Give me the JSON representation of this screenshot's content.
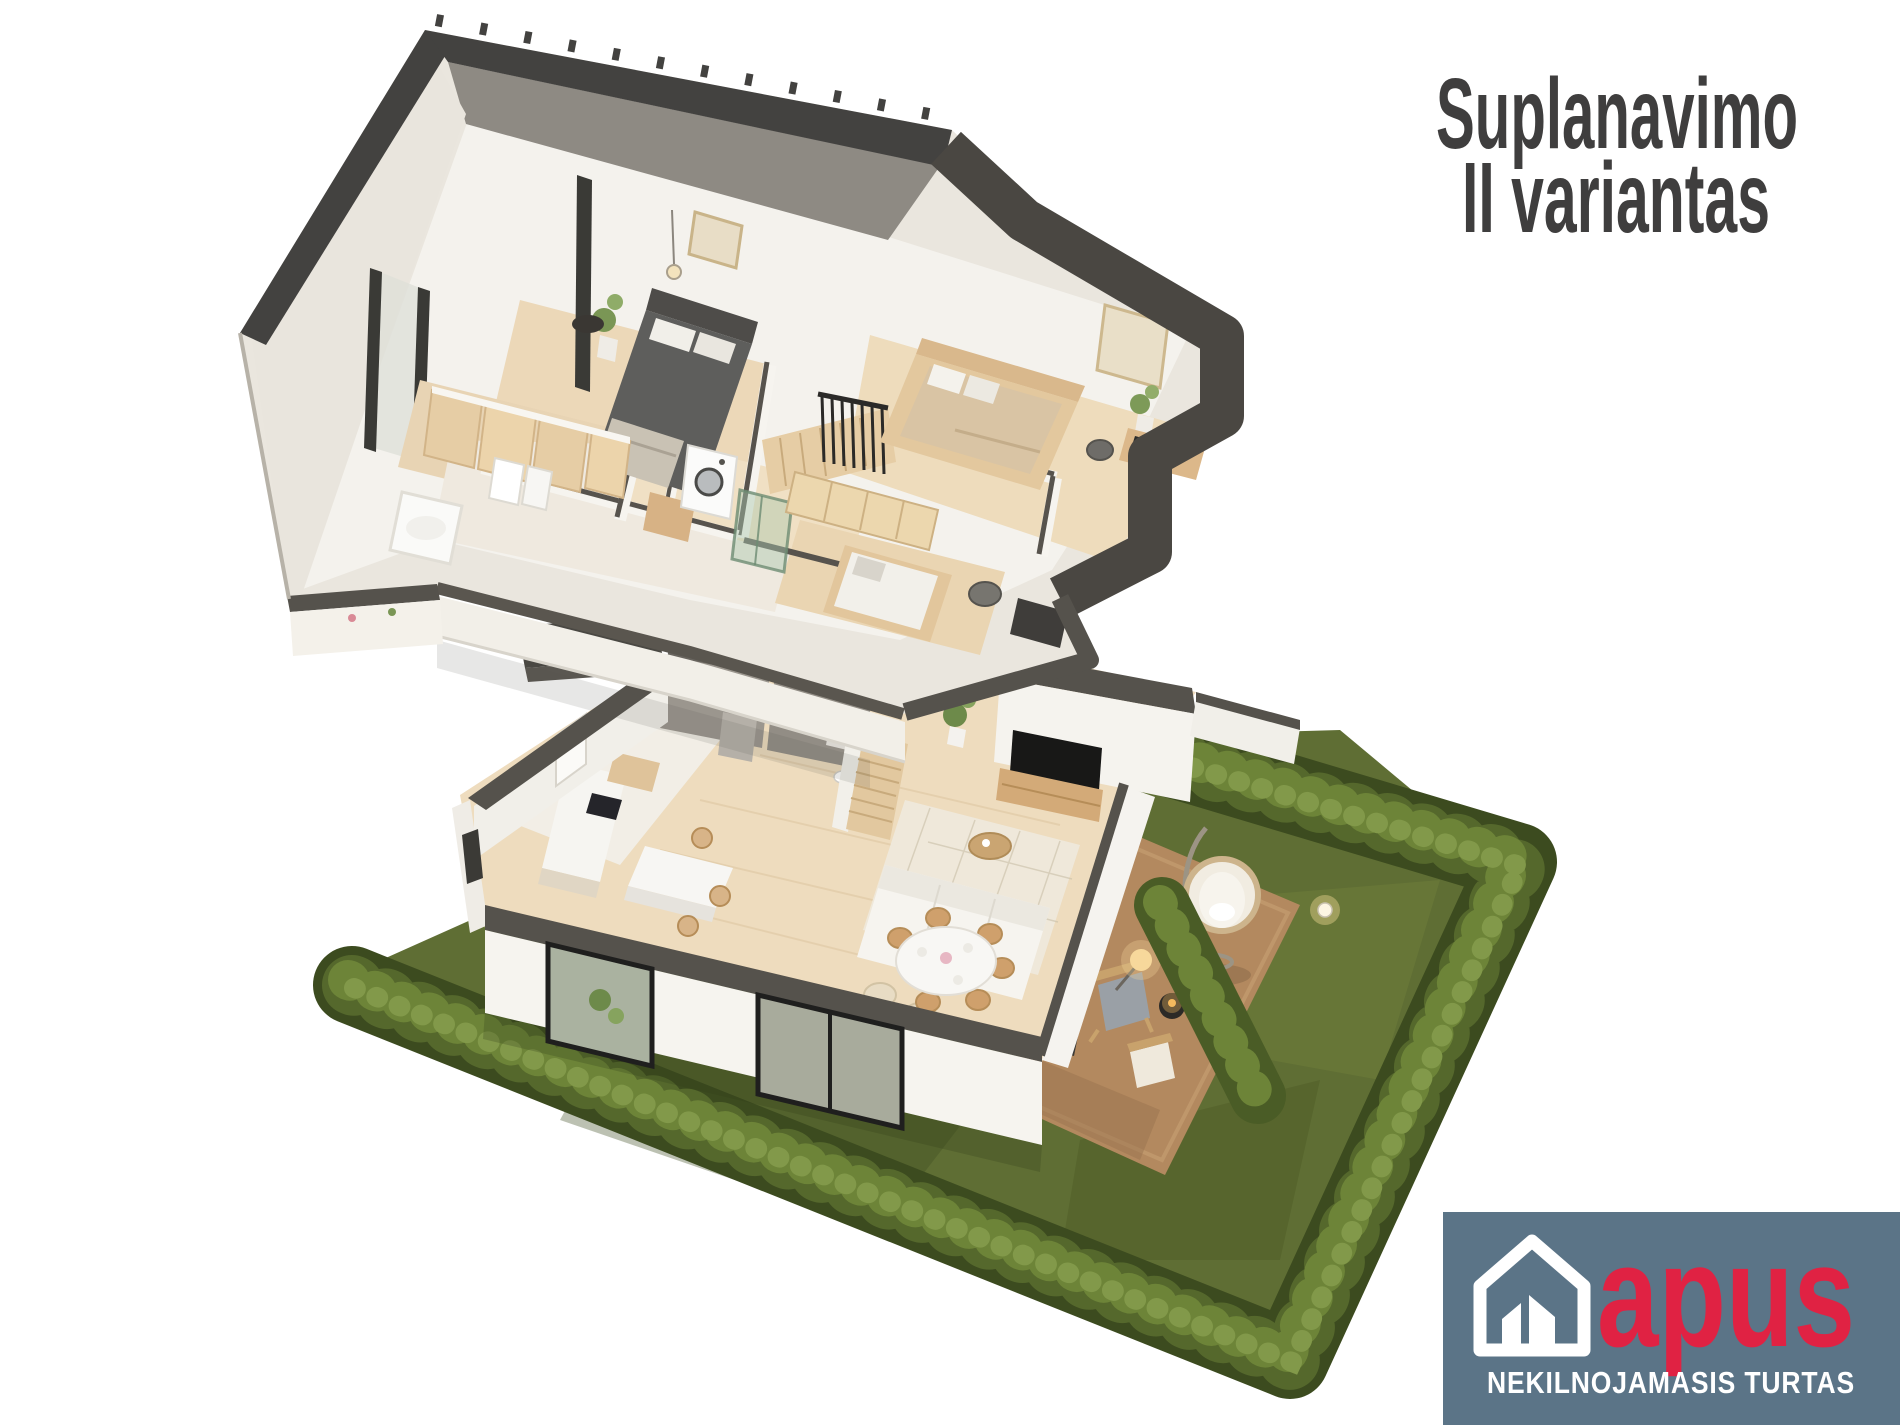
{
  "title": {
    "line1": "Suplanavimo",
    "line2": "II variantas"
  },
  "logo": {
    "brand": "apus",
    "tagline": "NEKILNOJAMASIS TURTAS",
    "house_icon": "house-icon"
  },
  "scene": {
    "type": "3d-cutaway-floor-plan",
    "floors_shown": 2,
    "garden_shown": true
  },
  "palette": {
    "background": "#ffffff",
    "title_text": "#3f3e3e",
    "logo_background": "#5b7487",
    "logo_brand_red": "#e02243",
    "logo_text": "#ffffff",
    "roof_dark": "#434240",
    "roof_slope_gray": "#8e8a83",
    "wall_top_dark": "#56524c",
    "wall_cream": "#eae6de",
    "wall_white": "#f6f4ef",
    "floor_wood": "#ecd8b8",
    "utility_gray": "#9b968e",
    "lawn_green": "#5f6e34",
    "hedge_green": "#55682c",
    "patio_rug_brown": "#b3895f",
    "warm_glow": "#f2c879"
  }
}
